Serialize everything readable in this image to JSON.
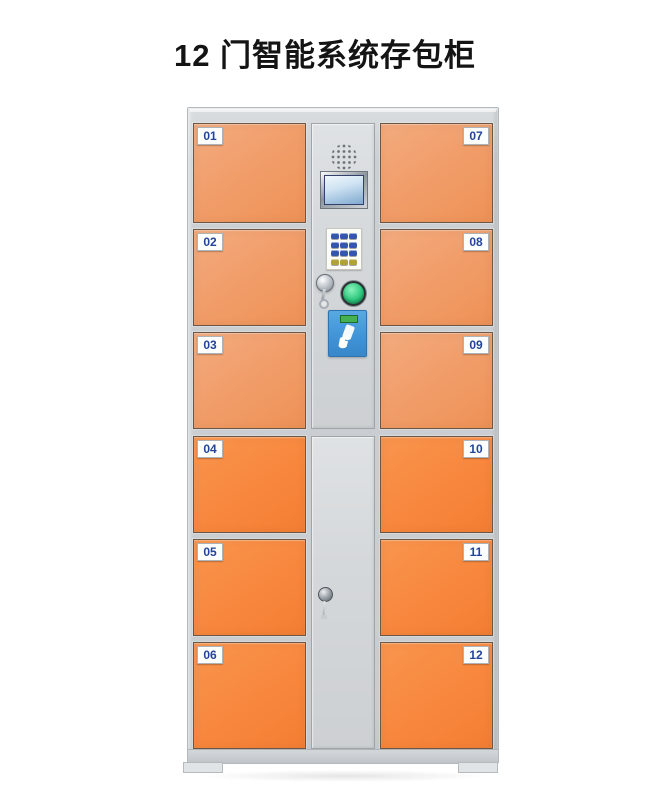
{
  "page": {
    "title": "12 门智能系统存包柜"
  },
  "locker": {
    "left_doors": [
      "01",
      "02",
      "03",
      "04",
      "05",
      "06"
    ],
    "right_doors": [
      "07",
      "08",
      "09",
      "10",
      "11",
      "12"
    ],
    "control_panel": {
      "components": [
        "speaker-grille",
        "lcd-display",
        "keypad",
        "key-lock",
        "confirm-button",
        "card-reader"
      ]
    },
    "icons": {
      "speaker": "speaker-grille",
      "display": "lcd-display",
      "hand": "hand-swipe-card-icon"
    }
  },
  "colors": {
    "door_orange_top": "#f19e6b",
    "door_orange_bottom": "#f8873d",
    "frame_gray": "#ccd0d3",
    "panel_gray": "#d5d8da",
    "label_blue": "#24449c",
    "key_blue": "#3556ae",
    "key_yellow": "#b0a238",
    "button_green": "#2ec87d",
    "reader_blue": "#3f93d6",
    "reader_screen_green": "#46b054",
    "lcd_screen_blue": "#cfe3f3"
  }
}
